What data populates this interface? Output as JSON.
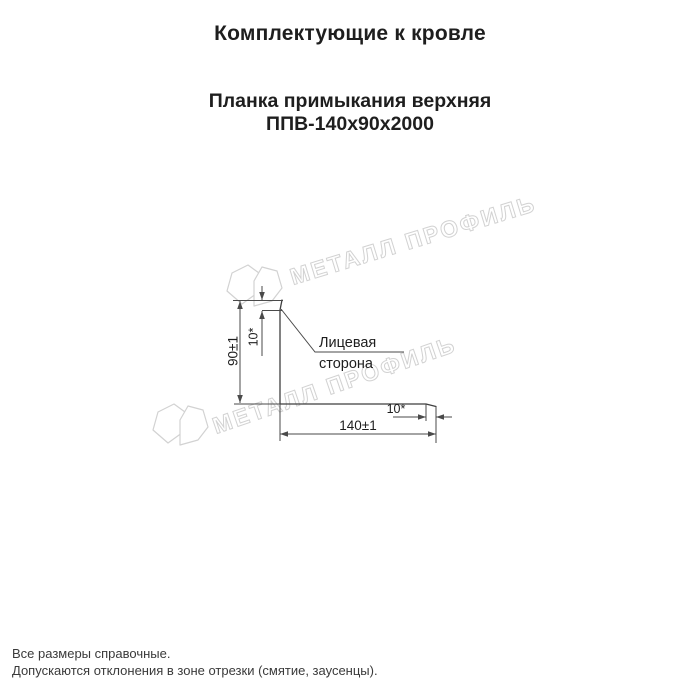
{
  "header": {
    "title": "Комплектующие к кровле",
    "product_name": "Планка примыкания верхняя",
    "product_code": "ППВ-140х90х2000"
  },
  "drawing": {
    "dim_height": "90±1",
    "dim_width": "140±1",
    "dim_hem_top": "10*",
    "dim_hem_end": "10*",
    "face_side_label_line1": "Лицевая",
    "face_side_label_line2": "сторона"
  },
  "watermark": {
    "text": "МЕТАЛЛ ПРОФИЛЬ"
  },
  "footer": {
    "line1": "Все размеры справочные.",
    "line2": "Допускаются отклонения в зоне отрезки (смятие, заусенцы)."
  },
  "colors": {
    "line": "#3f3f3f",
    "dim": "#4a4a4a",
    "text": "#1e1e1e",
    "watermark": "#d2d2d2",
    "page_bg": "#ffffff"
  }
}
